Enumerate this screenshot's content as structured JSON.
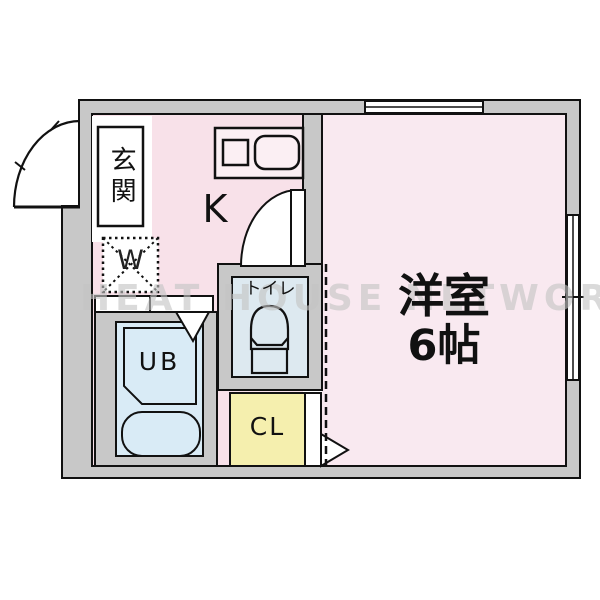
{
  "floorplan": {
    "watermark": "HEAT HOUSE NETWORK",
    "labels": {
      "entrance": "玄関",
      "kitchen": "K",
      "washer": "W",
      "toilet": "トイレ",
      "bath": "UB",
      "closet": "CL",
      "main_room_name": "洋室",
      "main_room_size": "6帖"
    },
    "colors": {
      "wall": "#c8c8c8",
      "kitchen": "#f8e1e9",
      "main_room": "#f9e9f0",
      "toilet": "#dde9f0",
      "bath": "#d9ebf6",
      "closet": "#f5efae",
      "counter": "#fbeff3",
      "outline": "#111111",
      "watermark": "#c8c8c8"
    }
  }
}
